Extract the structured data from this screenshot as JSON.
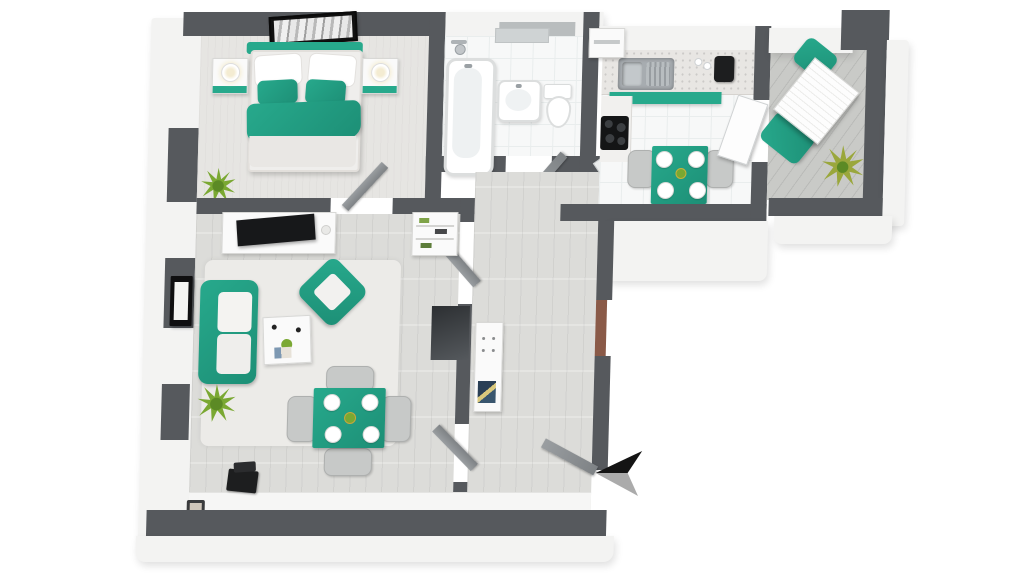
{
  "scene": {
    "description": "3D rendered top-down floor plan of a one-bedroom apartment with teal accent furniture",
    "render_style": "3d-isometric-floorplan",
    "text_labels": [],
    "compass": {
      "icon": "north-arrow-icon",
      "pointing": "left"
    }
  },
  "colors": {
    "background": "#ffffff",
    "wall": "#56595d",
    "exterior": "#f3f3f2",
    "floor-wood": "#dcdcd9",
    "floor-tile": "#f7f8f8",
    "floor-carpet": "#e6e5e2",
    "deck": "#c9cac7",
    "rug": "#ecebe8",
    "accent-teal": "#27a98c",
    "accent-teal-dark": "#1d8f76",
    "white-furniture": "#fafafa",
    "gray-furniture": "#c7c9c8",
    "door-gray": "#8b8f93",
    "door-entry-brown": "#8a5a48",
    "plant": "#7aa832",
    "plant-dark": "#5c8a25",
    "black-item": "#1d1e1f",
    "steel": "#a7acb0"
  },
  "rooms": [
    {
      "name": "bedroom",
      "furniture": [
        "double-bed-with-teal-blanket",
        "white-pillows",
        "teal-accent-pillows",
        "nightstand-left-with-lamp",
        "nightstand-right-with-lamp",
        "wall-art-above-bed",
        "floor-plant"
      ]
    },
    {
      "name": "bathroom",
      "furniture": [
        "bathtub-with-shower",
        "washbasin",
        "toilet",
        "mirror-shelf"
      ]
    },
    {
      "name": "kitchen",
      "furniture": [
        "counter-with-sink",
        "teal-cabinet-fronts",
        "cooktop-stove",
        "coffee-machine",
        "square-teal-dining-table",
        "four-white-plates",
        "gray-chairs",
        "tall-cabinet"
      ]
    },
    {
      "name": "balcony",
      "furniture": [
        "white-slatted-table",
        "teal-chair-top",
        "teal-chair-left",
        "potted-plant",
        "plank-decking"
      ]
    },
    {
      "name": "living-room",
      "furniture": [
        "teal-sofa-white-cushions",
        "teal-armchair",
        "white-coffee-table",
        "tv-sideboard-with-tv",
        "teal-dining-table",
        "four-white-plates",
        "four-gray-chairs",
        "area-rug",
        "floor-plant",
        "wall-picture",
        "laptop-on-sill",
        "small-framed-photo",
        "shoe-shelf"
      ]
    },
    {
      "name": "hallway",
      "furniture": [
        "white-dresser-with-magazines",
        "dark-mirror-niche",
        "entry-door-brown",
        "open-doors"
      ]
    }
  ],
  "doors": [
    "bedroom-door",
    "bathroom-door",
    "kitchen-door",
    "balcony-door",
    "living-room-door-top",
    "living-room-door-bottom",
    "entrance-door-open"
  ],
  "windows": [
    "bedroom-left-window",
    "living-left-window-upper",
    "living-left-window-lower",
    "bathroom-top-window",
    "kitchen-top-window"
  ]
}
